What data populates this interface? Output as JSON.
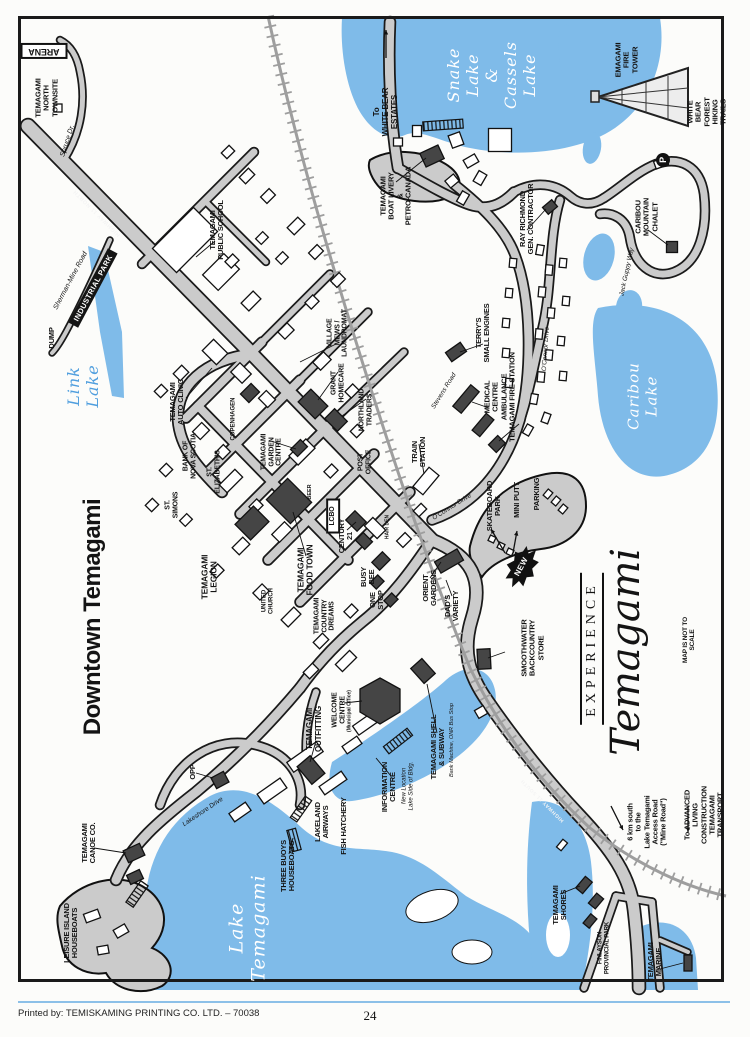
{
  "page": {
    "footer": {
      "printed_by": "Printed by: TEMISKAMING PRINTING CO. LTD. – 70038",
      "page_number": "24"
    }
  },
  "map": {
    "title": "Downtown Temagami",
    "scale_note": "MAP IS NOT TO SCALE",
    "colors": {
      "lake_blue": "#7fbbe9",
      "road_gray": "#cbcbcb",
      "building_dark": "#454545",
      "footer_rule_blue": "#8cc0e8",
      "link_lake_text_blue": "#4f9ede"
    },
    "labels": [
      {
        "name": "map-title",
        "text": "Downtown Temagami",
        "x": 93,
        "y": 617,
        "rot": -90,
        "fs": 24,
        "type": "title"
      },
      {
        "name": "label-arena",
        "text": "ARENA",
        "x": 44,
        "y": 51,
        "rot": 180,
        "fs": 9,
        "type": "boxed"
      },
      {
        "name": "label-north-townsite",
        "text": "TEMAGAMI\nNORTH\nTOWNSITE",
        "x": 47,
        "y": 98,
        "rot": -90,
        "fs": 7.5
      },
      {
        "name": "road-spruce-dr",
        "text": "Spruce Dr.",
        "x": 68,
        "y": 141,
        "rot": -72,
        "fs": 7,
        "type": "italic"
      },
      {
        "name": "road-highway-11-north",
        "text": "HIGHWAY 11 NORTH",
        "x": 97,
        "y": 213,
        "rot": -135,
        "fs": 5.5,
        "type": "roadwhite"
      },
      {
        "name": "label-dump",
        "text": "DUMP",
        "x": 52,
        "y": 338,
        "rot": -90,
        "fs": 7.5
      },
      {
        "name": "road-sherman-mine",
        "text": "Sherman-Mine Road",
        "x": 71,
        "y": 281,
        "rot": -62,
        "fs": 7,
        "type": "italic"
      },
      {
        "name": "label-industrial-park",
        "text": "INDUSTRIAL PARK",
        "x": 93,
        "y": 288,
        "rot": -62,
        "fs": 7.5,
        "type": "bar"
      },
      {
        "name": "label-link-lake",
        "text": "Link\nLake",
        "x": 84,
        "y": 386,
        "rot": -90,
        "fs": 16,
        "type": "script",
        "color": "#4f9ede"
      },
      {
        "name": "label-public-school",
        "text": "TEMAGAMI\nPUBLIC SCHOOL",
        "x": 217,
        "y": 230,
        "rot": -90,
        "fs": 7.5
      },
      {
        "name": "label-white-bear-estates",
        "text": "To\nWHITE BEAR\nESTATES",
        "x": 386,
        "y": 112,
        "rot": -90,
        "fs": 8
      },
      {
        "name": "label-snake-cassels-lake",
        "text": "Snake\nLake\n&\nCassels\nLake",
        "x": 492,
        "y": 75,
        "rot": -90,
        "fs": 16,
        "type": "script",
        "color": "#ffffff"
      },
      {
        "name": "label-fire-tower",
        "text": "EMAGAMI\nFIRE\nTOWER",
        "x": 627,
        "y": 60,
        "rot": -90,
        "fs": 7.5
      },
      {
        "name": "label-white-bear-forest",
        "text": "WHITE BEAR FOREST\nHIKING TRAILS",
        "x": 707,
        "y": 112,
        "rot": -90,
        "fs": 7.5
      },
      {
        "name": "label-caribou-chalet",
        "text": "CARIBOU\nMOUNTAIN\nCHALET",
        "x": 647,
        "y": 217,
        "rot": -90,
        "fs": 7.5
      },
      {
        "name": "road-jack-guppy-way",
        "text": "Jack Guppy Way",
        "x": 627,
        "y": 272,
        "rot": -78,
        "fs": 6.5,
        "type": "italic"
      },
      {
        "name": "label-parking-p",
        "text": "P",
        "x": 663,
        "y": 160,
        "rot": -90,
        "fs": 9,
        "type": "pcircle"
      },
      {
        "name": "label-boat-livery",
        "text": "TEMAGAMI\nBOAT LIVERY\n&\nPETRO-CANADA",
        "x": 396,
        "y": 196,
        "rot": -90,
        "fs": 7.5
      },
      {
        "name": "label-ray-richmond",
        "text": "RAY RICHMOND\nGEN. CONTRACTOR",
        "x": 527,
        "y": 219,
        "rot": -90,
        "fs": 7.5
      },
      {
        "name": "label-terrys-small-engines",
        "text": "TERRY'S\nSMALL ENGINES",
        "x": 483,
        "y": 333,
        "rot": -90,
        "fs": 7.5
      },
      {
        "name": "label-medical-fire",
        "text": "MEDICAL\nCENTRE\nAMBULANCE\nTEMAGAMI FIRE STATION",
        "x": 500,
        "y": 397,
        "rot": -90,
        "fs": 7.5
      },
      {
        "name": "road-stevens",
        "text": "Stevens Road",
        "x": 444,
        "y": 391,
        "rot": -58,
        "fs": 6.5,
        "type": "italic"
      },
      {
        "name": "label-train-station",
        "text": "TRAIN\nSTATION",
        "x": 419,
        "y": 452,
        "rot": -90,
        "fs": 7.5
      },
      {
        "name": "road-oconnor-main",
        "text": "O'Connor Drive",
        "x": 452,
        "y": 507,
        "rot": -32,
        "fs": 6.5,
        "type": "italic"
      },
      {
        "name": "road-oconnor-crescent",
        "text": "O'Connor Drive",
        "x": 546,
        "y": 349,
        "rot": -86,
        "fs": 6.5,
        "type": "italic"
      },
      {
        "name": "label-caribou-lake",
        "text": "Caribou\nLake",
        "x": 643,
        "y": 396,
        "rot": -90,
        "fs": 15,
        "type": "script",
        "color": "#ffffff"
      },
      {
        "name": "label-auto-clinic",
        "text": "TEMAGAMI\nAUTO CLINIC",
        "x": 177,
        "y": 402,
        "rot": -90,
        "fs": 7.5
      },
      {
        "name": "label-copenhagen",
        "text": "COPENHAGEN",
        "x": 234,
        "y": 419,
        "rot": -90,
        "fs": 6,
        "type": "fsmall"
      },
      {
        "name": "label-bank-nova-scotia",
        "text": "BANK OF\nNOVA SCOTIA",
        "x": 190,
        "y": 456,
        "rot": -90,
        "fs": 7
      },
      {
        "name": "label-st-elizabeths",
        "text": "ST.\nELIZABETH'S",
        "x": 214,
        "y": 472,
        "rot": -90,
        "fs": 7
      },
      {
        "name": "label-st-simons",
        "text": "ST.\nSIMONS",
        "x": 172,
        "y": 505,
        "rot": -90,
        "fs": 7
      },
      {
        "name": "label-village-mews",
        "text": "VILLAGE\nMEWS /\nLAUNDROMAT",
        "x": 338,
        "y": 333,
        "rot": -90,
        "fs": 7
      },
      {
        "name": "label-grant-homecare",
        "text": "GRANT\nHOMECARE",
        "x": 338,
        "y": 383,
        "rot": -90,
        "fs": 7
      },
      {
        "name": "label-northland-traders",
        "text": "NORTHLAND\nTRADERS",
        "x": 366,
        "y": 410,
        "rot": -90,
        "fs": 7
      },
      {
        "name": "label-post-office",
        "text": "POST\nOFFICE",
        "x": 365,
        "y": 462,
        "rot": -90,
        "fs": 7
      },
      {
        "name": "label-garden-centre",
        "text": "TEMAGAMI\nGARDEN\nCENTRE",
        "x": 272,
        "y": 452,
        "rot": -90,
        "fs": 7
      },
      {
        "name": "label-beer",
        "text": "BEER",
        "x": 310,
        "y": 492,
        "rot": -90,
        "fs": 5.5,
        "type": "fsmall"
      },
      {
        "name": "label-lcbo",
        "text": "LCBO",
        "x": 333,
        "y": 516,
        "rot": -90,
        "fs": 7,
        "type": "boxed"
      },
      {
        "name": "label-century-21",
        "text": "CENTURY\n21",
        "x": 346,
        "y": 536,
        "rot": -90,
        "fs": 7.5
      },
      {
        "name": "label-food-town",
        "text": "TEMAGAMI\nFOOD TOWN",
        "x": 306,
        "y": 570,
        "rot": -90,
        "fs": 8.5
      },
      {
        "name": "label-legion",
        "text": "TEMAGAMI\nLEGION",
        "x": 210,
        "y": 577,
        "rot": -90,
        "fs": 8.5
      },
      {
        "name": "label-united-church",
        "text": "UNITED\nCHURCH",
        "x": 268,
        "y": 601,
        "rot": -90,
        "fs": 6,
        "type": "fsmall"
      },
      {
        "name": "label-busy-bee",
        "text": "BUSY\nBEE",
        "x": 368,
        "y": 577,
        "rot": -90,
        "fs": 7.5
      },
      {
        "name": "label-one-stop",
        "text": "ONE\nSTOP",
        "x": 377,
        "y": 600,
        "rot": -90,
        "fs": 7.5
      },
      {
        "name": "label-country-dreams",
        "text": "TEMAGAMI\nCOUNTRY\nDREAMS",
        "x": 325,
        "y": 616,
        "rot": -90,
        "fs": 7
      },
      {
        "name": "label-hair-den",
        "text": "HAIR DEN",
        "x": 388,
        "y": 527,
        "rot": -90,
        "fs": 5,
        "type": "fsmall"
      },
      {
        "name": "label-orient-gardens",
        "text": "ORIENT\nGARDENS",
        "x": 430,
        "y": 588,
        "rot": -90,
        "fs": 7.5
      },
      {
        "name": "label-dads-variety",
        "text": "DAD'S\nVARIETY",
        "x": 452,
        "y": 606,
        "rot": -90,
        "fs": 7.5
      },
      {
        "name": "label-skateboard-park",
        "text": "SKATEBOARD\nPARK",
        "x": 494,
        "y": 506,
        "rot": -90,
        "fs": 7.5
      },
      {
        "name": "label-mini-putt",
        "text": "MINI PUTT",
        "x": 517,
        "y": 500,
        "rot": -90,
        "fs": 7.5
      },
      {
        "name": "label-parking",
        "text": "PARKING",
        "x": 537,
        "y": 494,
        "rot": -90,
        "fs": 7.5
      },
      {
        "name": "label-new",
        "text": "NEW",
        "x": 522,
        "y": 567,
        "rot": -62,
        "fs": 8,
        "type": "new-label"
      },
      {
        "name": "logo-experience",
        "text": "EXPERIENCE",
        "x": 592,
        "y": 649,
        "rot": -90,
        "fs": 14,
        "type": "logo-exp"
      },
      {
        "name": "logo-temagami",
        "text": "Temagami",
        "x": 626,
        "y": 652,
        "rot": -90,
        "fs": 40,
        "type": "logo-script"
      },
      {
        "name": "label-not-to-scale",
        "text": "MAP IS NOT TO SCALE",
        "x": 689,
        "y": 640,
        "rot": -90,
        "fs": 6.5
      },
      {
        "name": "label-smoothwater",
        "text": "SMOOTHWATER\nBACKCOUNTRY\nSTORE",
        "x": 533,
        "y": 648,
        "rot": -90,
        "fs": 7.5
      },
      {
        "name": "label-shell-subway",
        "text": "TEMAGAMI SHELL\n& SUBWAY",
        "x": 438,
        "y": 747,
        "rot": -90,
        "fs": 7.5
      },
      {
        "name": "label-shell-note",
        "text": "Bank Machine, ONR Bus Stop",
        "x": 452,
        "y": 740,
        "rot": -90,
        "fs": 5.5,
        "type": "italic"
      },
      {
        "name": "label-information-centre",
        "text": "INFORMATION\nCENTRE",
        "x": 389,
        "y": 787,
        "rot": -90,
        "fs": 7.5
      },
      {
        "name": "label-information-note",
        "text": "New Location\nLake Side of Bldg.",
        "x": 408,
        "y": 786,
        "rot": -90,
        "fs": 6,
        "type": "italic"
      },
      {
        "name": "label-welcome-centre",
        "text": "WELCOME\nCENTRE",
        "x": 339,
        "y": 710,
        "rot": -90,
        "fs": 7
      },
      {
        "name": "label-welcome-note",
        "text": "(Municipal Office)",
        "x": 350,
        "y": 711,
        "rot": -90,
        "fs": 5,
        "type": "fsmall"
      },
      {
        "name": "label-outfitting",
        "text": "TEMAGAMI\nOUTFITTING",
        "x": 315,
        "y": 729,
        "rot": -90,
        "fs": 8
      },
      {
        "name": "label-opp",
        "text": "OPP",
        "x": 193,
        "y": 772,
        "rot": -90,
        "fs": 7.5
      },
      {
        "name": "road-lakeshore",
        "text": "Lakeshore Drive",
        "x": 203,
        "y": 812,
        "rot": -34,
        "fs": 6.5,
        "type": "italic"
      },
      {
        "name": "label-lakeland-airways",
        "text": "LAKELAND\nAIRWAYS",
        "x": 322,
        "y": 822,
        "rot": -90,
        "fs": 7.5
      },
      {
        "name": "label-fish-hatchery",
        "text": "FISH HATCHERY",
        "x": 344,
        "y": 826,
        "rot": -90,
        "fs": 7.5
      },
      {
        "name": "label-three-buoys",
        "text": "THREE BUOYS\nHOUSEBOATS",
        "x": 288,
        "y": 866,
        "rot": -90,
        "fs": 7.5
      },
      {
        "name": "label-canoe-co",
        "text": "TEMAGAMI\nCANOE CO.",
        "x": 89,
        "y": 843,
        "rot": -90,
        "fs": 7.5
      },
      {
        "name": "label-leisure-island",
        "text": "LEISURE ISLAND\nHOUSEBOATS",
        "x": 71,
        "y": 933,
        "rot": -90,
        "fs": 7.5
      },
      {
        "name": "label-lake-temagami",
        "text": "Lake\nTemagami",
        "x": 248,
        "y": 928,
        "rot": -90,
        "fs": 19,
        "type": "script",
        "color": "#ffffff"
      },
      {
        "name": "label-temagami-shores",
        "text": "TEMAGAMI\nSHORES",
        "x": 560,
        "y": 905,
        "rot": -90,
        "fs": 7.5
      },
      {
        "name": "label-finlayson-park",
        "text": "FINLAYSON\nPROVINCIAL PARK",
        "x": 604,
        "y": 948,
        "rot": -90,
        "fs": 6
      },
      {
        "name": "label-temagami-marine",
        "text": "TEMAGAMI\nMARINE",
        "x": 655,
        "y": 962,
        "rot": -90,
        "fs": 7.5
      },
      {
        "name": "label-six-km-south",
        "text": "6 km south\nto the\nLake Temagami\nAccess Road\n(\"Mine Road\")",
        "x": 647,
        "y": 822,
        "rot": -90,
        "fs": 7.5
      },
      {
        "name": "label-advanced-living",
        "text": "To ADVANCED LIVING CONSTRUCTION\nTEMAGAMI TRANSPORT",
        "x": 704,
        "y": 815,
        "rot": -90,
        "fs": 7.5
      },
      {
        "name": "road-highway-11-south",
        "text": "HIGHWAY 11 SOUTH",
        "x": 543,
        "y": 800,
        "rot": -135,
        "fs": 5,
        "type": "roadwhite"
      }
    ]
  }
}
